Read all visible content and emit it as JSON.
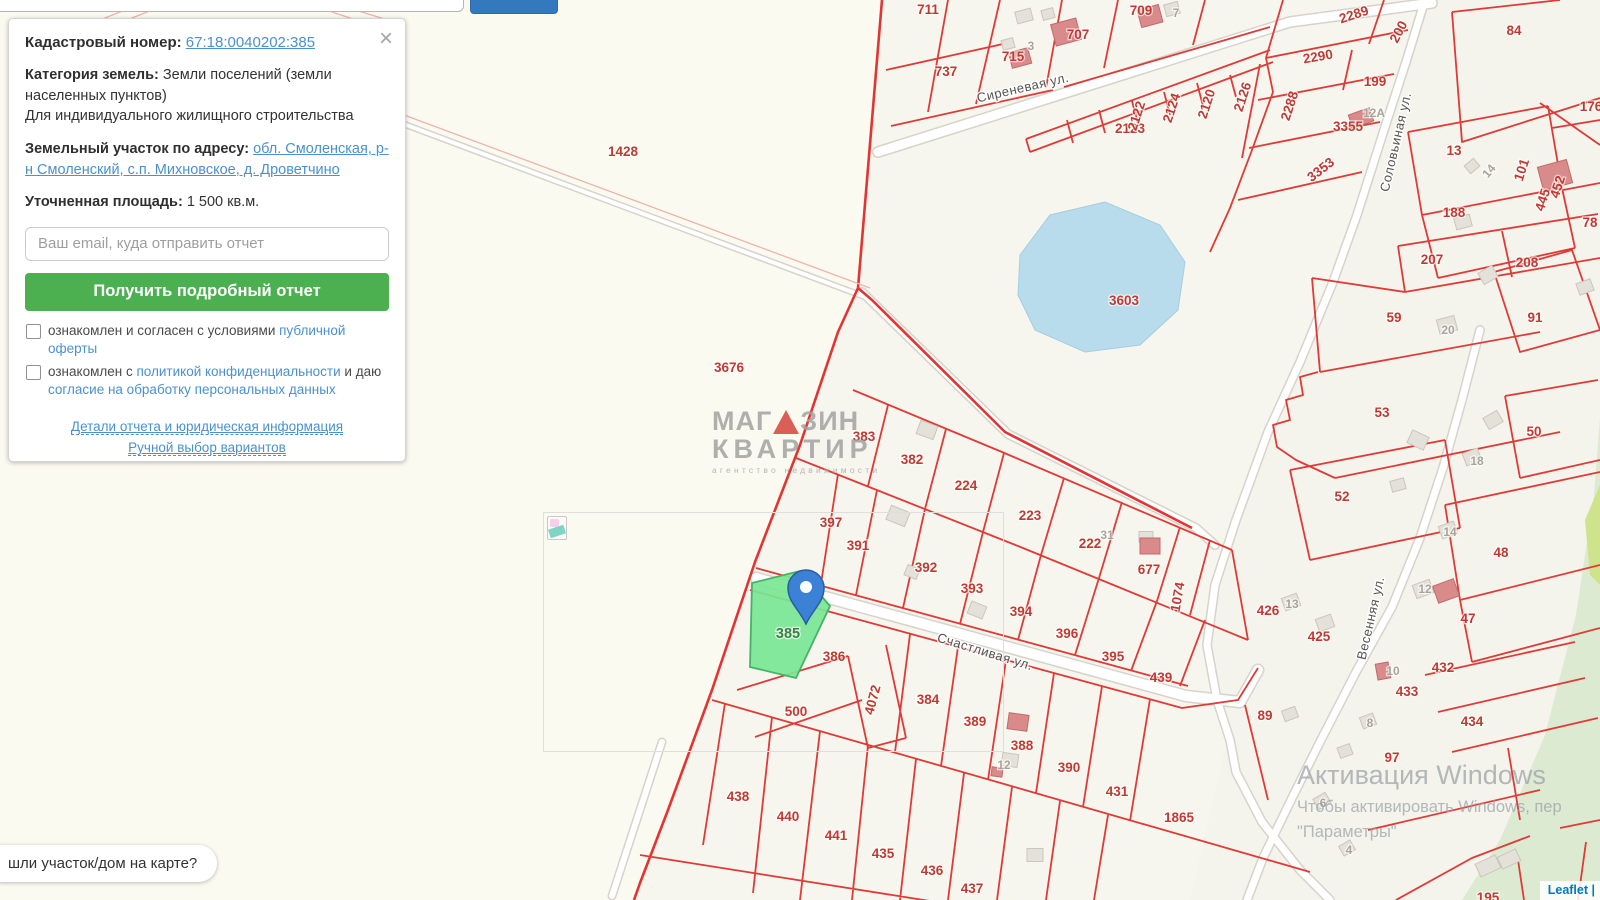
{
  "search": {
    "placeholder": "",
    "button_label": ""
  },
  "panel": {
    "close_icon": "×",
    "kadastr_label": "Кадастровый номер:",
    "kadastr_number": "67:18:0040202:385",
    "category_label": "Категория земель:",
    "category_value": "Земли поселений (земли населенных пунктов)",
    "category_extra": "Для индивидуального жилищного строительства",
    "address_label": "Земельный участок по адресу:",
    "address_link": "обл. Смоленская, р-н Смоленский, с.п. Михновское, д. Дроветчино",
    "area_label": "Уточненная площадь:",
    "area_value": "1 500 кв.м.",
    "email_placeholder": "Ваш email, куда отправить отчет",
    "submit_label": "Получить подробный отчет",
    "agree1_text": "ознакомлен и согласен с условиями",
    "agree1_link": "публичной оферты",
    "agree2_text": "ознакомлен с",
    "agree2_link": "политикой конфиденциальности",
    "agree2_text2": "и даю",
    "agree2_link2": "согласие на обработку персональных данных",
    "details_link": "Детали отчета и юридическая информация",
    "manual_link": "Ручной выбор вариантов"
  },
  "map": {
    "tooltip_text": "шли участок/дом на карте?",
    "attribution": "Leaflet |",
    "selected_parcel_number": "385",
    "watermark": {
      "line1a": "МАГ",
      "line1b": "ЗИН",
      "line2": "КВАРТИР",
      "line3": "агентство недвижимости"
    },
    "windows_overlay": {
      "line1": "Активация Windows",
      "line2": "Чтобы активировать Windows, пер",
      "line3": "\"Параметры\""
    },
    "streets": [
      {
        "t": "Сиреневая ул.",
        "x": 1023,
        "y": 88,
        "r": -13
      },
      {
        "t": "Соловьиная ул.",
        "x": 1396,
        "y": 142,
        "r": -77
      },
      {
        "t": "Счастливая ул.",
        "x": 985,
        "y": 652,
        "r": 17
      },
      {
        "t": "Весенняя ул.",
        "x": 1371,
        "y": 618,
        "r": -77
      }
    ],
    "parcel_labels": [
      {
        "t": "711",
        "x": 928,
        "y": 10
      },
      {
        "t": "737",
        "x": 946,
        "y": 72
      },
      {
        "t": "715",
        "x": 1013,
        "y": 57
      },
      {
        "t": "3",
        "x": 1031,
        "y": 46,
        "c": "gray"
      },
      {
        "t": "707",
        "x": 1078,
        "y": 35
      },
      {
        "t": "709",
        "x": 1141,
        "y": 11
      },
      {
        "t": "7",
        "x": 1176,
        "y": 13,
        "c": "gray"
      },
      {
        "t": "2123",
        "x": 1130,
        "y": 129
      },
      {
        "t": "2122",
        "x": 1137,
        "y": 116,
        "r": -72
      },
      {
        "t": "2124",
        "x": 1172,
        "y": 108,
        "r": -72
      },
      {
        "t": "2120",
        "x": 1207,
        "y": 104,
        "r": -72
      },
      {
        "t": "2126",
        "x": 1243,
        "y": 97,
        "r": -72
      },
      {
        "t": "2288",
        "x": 1290,
        "y": 106,
        "r": -72
      },
      {
        "t": "2289",
        "x": 1354,
        "y": 15,
        "r": -18
      },
      {
        "t": "200",
        "x": 1399,
        "y": 32,
        "r": -62
      },
      {
        "t": "2290",
        "x": 1318,
        "y": 57,
        "r": -10
      },
      {
        "t": "199",
        "x": 1375,
        "y": 82
      },
      {
        "t": "84",
        "x": 1514,
        "y": 31
      },
      {
        "t": "3355",
        "x": 1348,
        "y": 127
      },
      {
        "t": "12A",
        "x": 1374,
        "y": 113,
        "c": "gray"
      },
      {
        "t": "3353",
        "x": 1321,
        "y": 170,
        "r": -38
      },
      {
        "t": "13",
        "x": 1454,
        "y": 151
      },
      {
        "t": "176",
        "x": 1591,
        "y": 107
      },
      {
        "t": "14",
        "x": 1489,
        "y": 171,
        "r": -50,
        "c": "gray"
      },
      {
        "t": "101",
        "x": 1522,
        "y": 170,
        "r": -72
      },
      {
        "t": "445",
        "x": 1543,
        "y": 200,
        "r": -72
      },
      {
        "t": "452",
        "x": 1558,
        "y": 187,
        "r": -72
      },
      {
        "t": "188",
        "x": 1454,
        "y": 213
      },
      {
        "t": "78",
        "x": 1590,
        "y": 223
      },
      {
        "t": "207",
        "x": 1432,
        "y": 260
      },
      {
        "t": "208",
        "x": 1527,
        "y": 263
      },
      {
        "t": "59",
        "x": 1394,
        "y": 318
      },
      {
        "t": "20",
        "x": 1448,
        "y": 330,
        "c": "gray"
      },
      {
        "t": "91",
        "x": 1535,
        "y": 318
      },
      {
        "t": "53",
        "x": 1382,
        "y": 413
      },
      {
        "t": "18",
        "x": 1477,
        "y": 461,
        "c": "gray"
      },
      {
        "t": "50",
        "x": 1534,
        "y": 432
      },
      {
        "t": "52",
        "x": 1342,
        "y": 497
      },
      {
        "t": "1428",
        "x": 623,
        "y": 152
      },
      {
        "t": "3603",
        "x": 1124,
        "y": 301
      },
      {
        "t": "3676",
        "x": 729,
        "y": 368
      },
      {
        "t": "383",
        "x": 864,
        "y": 437
      },
      {
        "t": "382",
        "x": 912,
        "y": 460
      },
      {
        "t": "224",
        "x": 966,
        "y": 486
      },
      {
        "t": "223",
        "x": 1030,
        "y": 516
      },
      {
        "t": "222",
        "x": 1090,
        "y": 544
      },
      {
        "t": "31",
        "x": 1107,
        "y": 535,
        "c": "gray"
      },
      {
        "t": "677",
        "x": 1149,
        "y": 570
      },
      {
        "t": "1074",
        "x": 1178,
        "y": 597,
        "r": -80
      },
      {
        "t": "397",
        "x": 831,
        "y": 523
      },
      {
        "t": "391",
        "x": 858,
        "y": 546
      },
      {
        "t": "392",
        "x": 926,
        "y": 568
      },
      {
        "t": "393",
        "x": 972,
        "y": 589
      },
      {
        "t": "394",
        "x": 1021,
        "y": 612
      },
      {
        "t": "396",
        "x": 1067,
        "y": 634
      },
      {
        "t": "395",
        "x": 1113,
        "y": 657
      },
      {
        "t": "439",
        "x": 1161,
        "y": 678
      },
      {
        "t": "385",
        "x": 788,
        "y": 634,
        "c": "sel"
      },
      {
        "t": "386",
        "x": 834,
        "y": 657
      },
      {
        "t": "500",
        "x": 796,
        "y": 712
      },
      {
        "t": "4072",
        "x": 873,
        "y": 700,
        "r": -75
      },
      {
        "t": "384",
        "x": 928,
        "y": 700
      },
      {
        "t": "389",
        "x": 975,
        "y": 722
      },
      {
        "t": "388",
        "x": 1022,
        "y": 746
      },
      {
        "t": "12",
        "x": 1004,
        "y": 765,
        "c": "gray"
      },
      {
        "t": "390",
        "x": 1069,
        "y": 768
      },
      {
        "t": "431",
        "x": 1117,
        "y": 792
      },
      {
        "t": "1865",
        "x": 1179,
        "y": 818
      },
      {
        "t": "438",
        "x": 738,
        "y": 797
      },
      {
        "t": "440",
        "x": 788,
        "y": 817
      },
      {
        "t": "441",
        "x": 836,
        "y": 836
      },
      {
        "t": "435",
        "x": 883,
        "y": 854
      },
      {
        "t": "436",
        "x": 932,
        "y": 871
      },
      {
        "t": "437",
        "x": 972,
        "y": 889
      },
      {
        "t": "426",
        "x": 1268,
        "y": 611
      },
      {
        "t": "13",
        "x": 1292,
        "y": 604,
        "c": "gray"
      },
      {
        "t": "425",
        "x": 1319,
        "y": 637
      },
      {
        "t": "89",
        "x": 1265,
        "y": 716
      },
      {
        "t": "14",
        "x": 1450,
        "y": 532,
        "c": "gray"
      },
      {
        "t": "48",
        "x": 1501,
        "y": 553
      },
      {
        "t": "12",
        "x": 1425,
        "y": 589,
        "c": "gray"
      },
      {
        "t": "47",
        "x": 1468,
        "y": 619
      },
      {
        "t": "432",
        "x": 1443,
        "y": 668
      },
      {
        "t": "433",
        "x": 1407,
        "y": 692
      },
      {
        "t": "10",
        "x": 1393,
        "y": 671,
        "c": "gray"
      },
      {
        "t": "434",
        "x": 1472,
        "y": 722
      },
      {
        "t": "8",
        "x": 1370,
        "y": 723,
        "c": "gray"
      },
      {
        "t": "97",
        "x": 1392,
        "y": 758
      },
      {
        "t": "6",
        "x": 1323,
        "y": 803,
        "c": "gray"
      },
      {
        "t": "4",
        "x": 1349,
        "y": 850,
        "c": "gray"
      },
      {
        "t": "195",
        "x": 1488,
        "y": 898
      }
    ],
    "colors": {
      "parcel_line": "#e03a36",
      "selected_fill": "#7ae695",
      "pond": "#b9dcec",
      "accent_button": "#4caf50",
      "link_blue": "#4a90d2",
      "pin_blue": "#3b82d6"
    }
  }
}
